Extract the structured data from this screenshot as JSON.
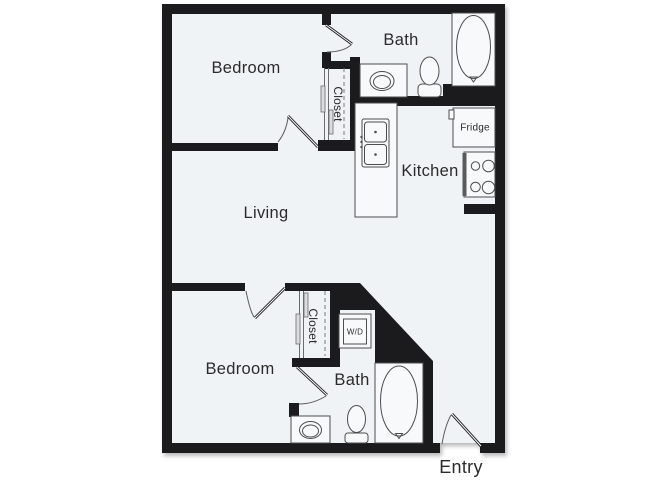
{
  "floor_plan": {
    "labels": {
      "bedroom_top": "Bedroom",
      "bath_top": "Bath",
      "closet_top": "Closet",
      "kitchen": "Kitchen",
      "fridge": "Fridge",
      "living": "Living",
      "closet_bottom": "Closet",
      "washer_dryer": "W/D",
      "bedroom_bottom": "Bedroom",
      "bath_bottom": "Bath",
      "entry": "Entry"
    },
    "colors": {
      "wall": "#1b1b1e",
      "floor": "#f0f3f5",
      "line": "#4d4d4d",
      "label": "#2b2b2b",
      "background": "#ffffff"
    }
  }
}
